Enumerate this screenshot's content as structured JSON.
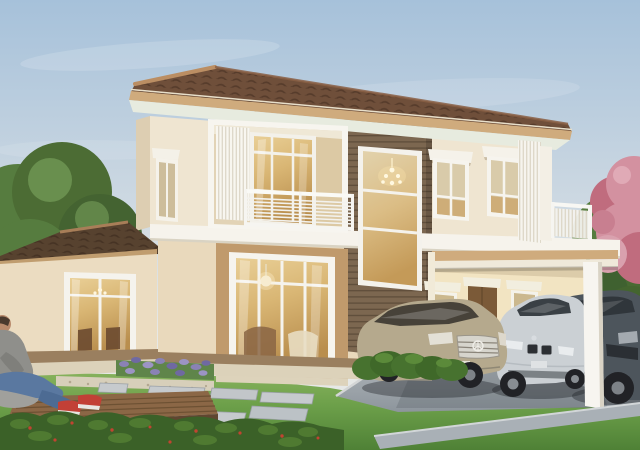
{
  "scene": {
    "type": "architectural-rendering",
    "description": "Daytime 3D rendering of a modern two-storey cream house with brown tiled hip roof, dark wood-slat accent panel, recessed balcony, carport with three parked cars, landscaped lawn with stepping stones, flowering hedge and a person relaxing on a wooden deck at lower left.",
    "objects": [
      "sky",
      "cloud streaks",
      "left tree",
      "right trees",
      "pink blossom tree",
      "two-storey house",
      "brown tiled hip roof",
      "single-storey wing",
      "wood-slat accent panel",
      "double-height window with chandelier",
      "recessed balcony with white railing",
      "balcony sliding door",
      "vertical louver screens",
      "bedroom windows with awning shades",
      "roof-deck railing",
      "living room window with pendant lamp",
      "carport beam and column",
      "carport entry door",
      "champagne sedan",
      "silver sedan",
      "graphite car",
      "driveway",
      "lawn",
      "stepping stones",
      "gravel strip",
      "purple flower bed",
      "trimmed shrubs",
      "flowering hedge with red blooms",
      "wooden deck",
      "person sitting with jeans and red sneakers"
    ]
  },
  "colors": {
    "sky_top": "#a6c1da",
    "sky_mid": "#c9d6e1",
    "sky_horizon": "#e6e8e6",
    "roof": "#6f4f3a",
    "roof_ridge": "#bb8e63",
    "fascia": "#cfab7d",
    "soffit": "#e7ebdf",
    "wing_roof": "#57422f",
    "wall": "#efe5d1",
    "wall_warm": "#e9d9bc",
    "wall_shadow": "#ddceb2",
    "carport_wall": "#f2e4c2",
    "trim": "#f6f3ec",
    "column_white": "#f7f5f0",
    "panel_brown": "#7c6750",
    "surround_tan": "#c09a6c",
    "door_brown": "#7b5a38",
    "glass_top": "#e9cf96",
    "glass_mid": "#d9b674",
    "glass_deep": "#b98e4e",
    "glass_pale": "#d9cbaa",
    "lawn_light": "#8ab45f",
    "lawn_mid": "#6da04a",
    "lawn_dark": "#4f8136",
    "hedge": "#3b6128",
    "hedge_light": "#527d33",
    "flower_red": "#c14431",
    "flower_purple": "#8a82b5",
    "blossom_pink": "#d391a0",
    "blossom_deep": "#c06c7e",
    "tree_green": "#567c3f",
    "tree_dark": "#446331",
    "stone_gray": "#c6cacd",
    "drive_light": "#b9bec2",
    "drive_dark": "#8d959c",
    "path_gray": "#a9b0b6",
    "deck_wood": "#8b6746",
    "deck_edge": "#5f4630",
    "gravel": "#d7cfba",
    "car_champagne": "#b5a98d",
    "car_silver": "#cbd0d4",
    "car_graphite": "#4d555c",
    "car_glass": "#3a4045",
    "wheel_dark": "#212226",
    "shirt_gray": "#8f8f8b",
    "jeans_blue": "#5a78a0",
    "sneaker_red": "#c24036"
  }
}
